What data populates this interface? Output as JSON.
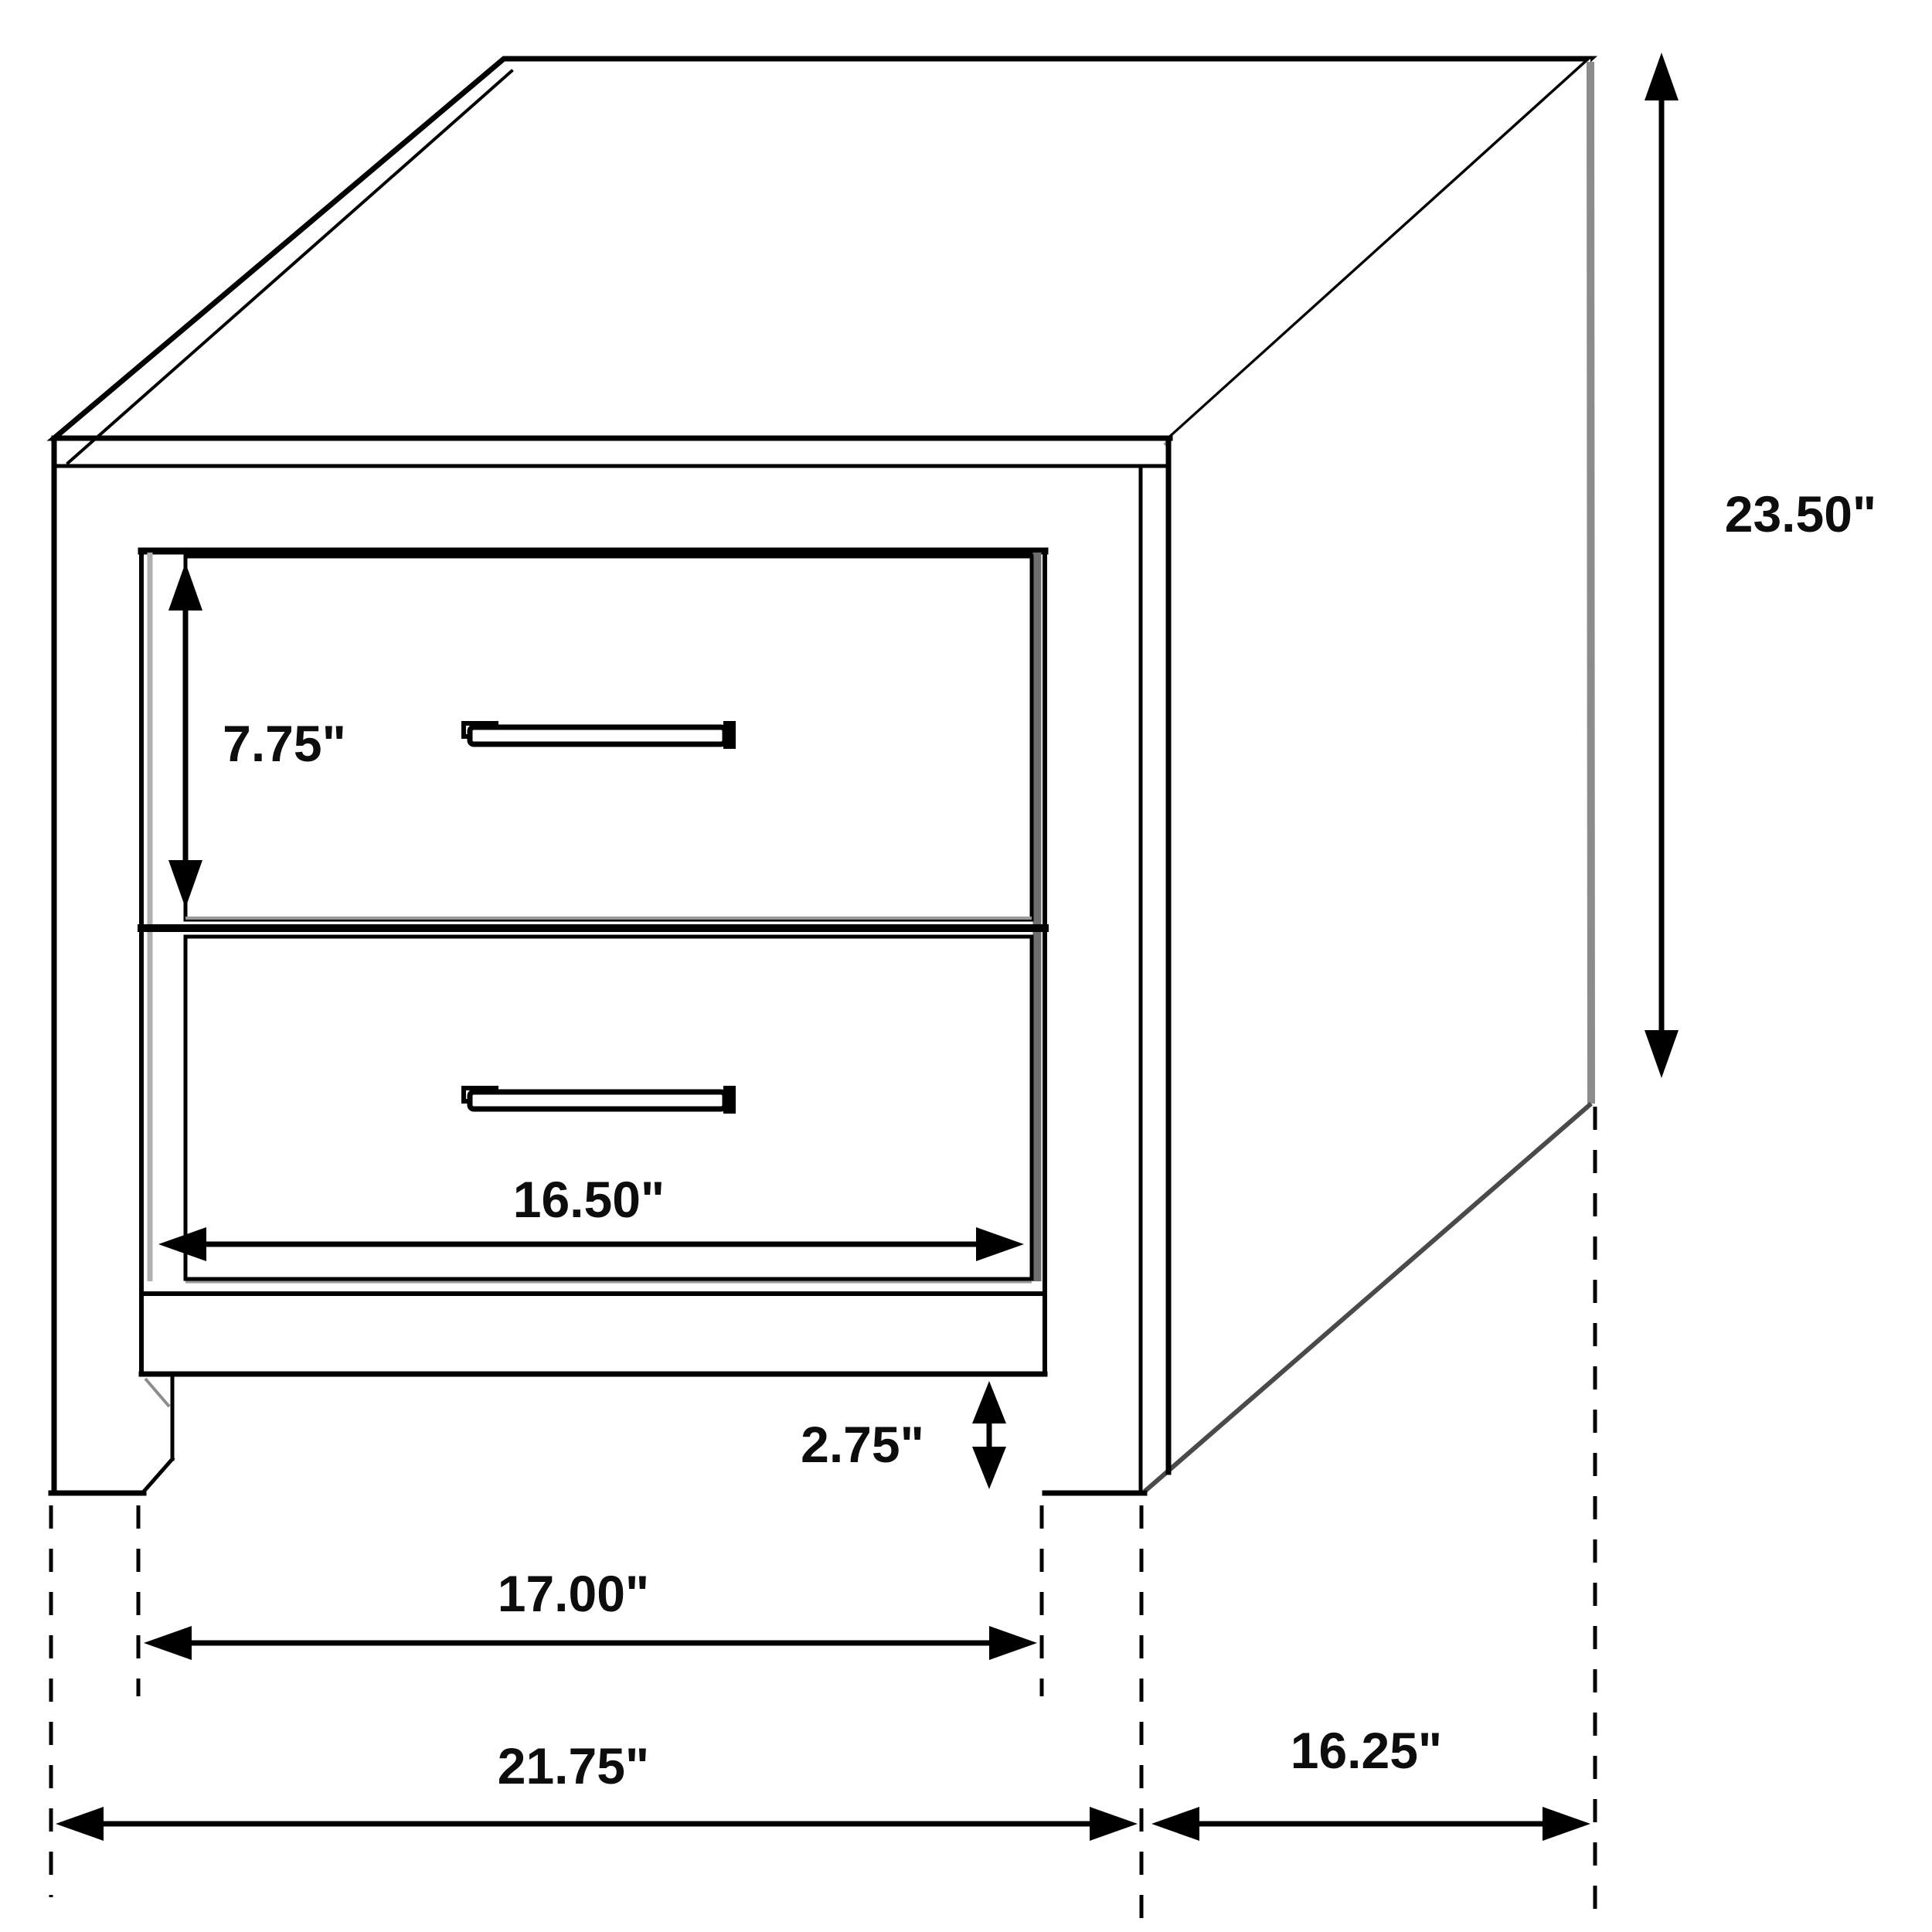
{
  "diagram": {
    "kind": "furniture-dimension-line-drawing",
    "subject": "two-drawer nightstand, three-quarter view",
    "unit": "inches",
    "background_color": "#ffffff",
    "line_color": "#000000",
    "shadow_color": "#8c8c8c",
    "dimensions": {
      "overall_height": "23.50\"",
      "top_drawer_height": "7.75\"",
      "drawer_width": "16.50\"",
      "leg_clearance_height": "2.75\"",
      "between_legs_width": "17.00\"",
      "overall_width": "21.75\"",
      "side_depth": "16.25\""
    }
  }
}
